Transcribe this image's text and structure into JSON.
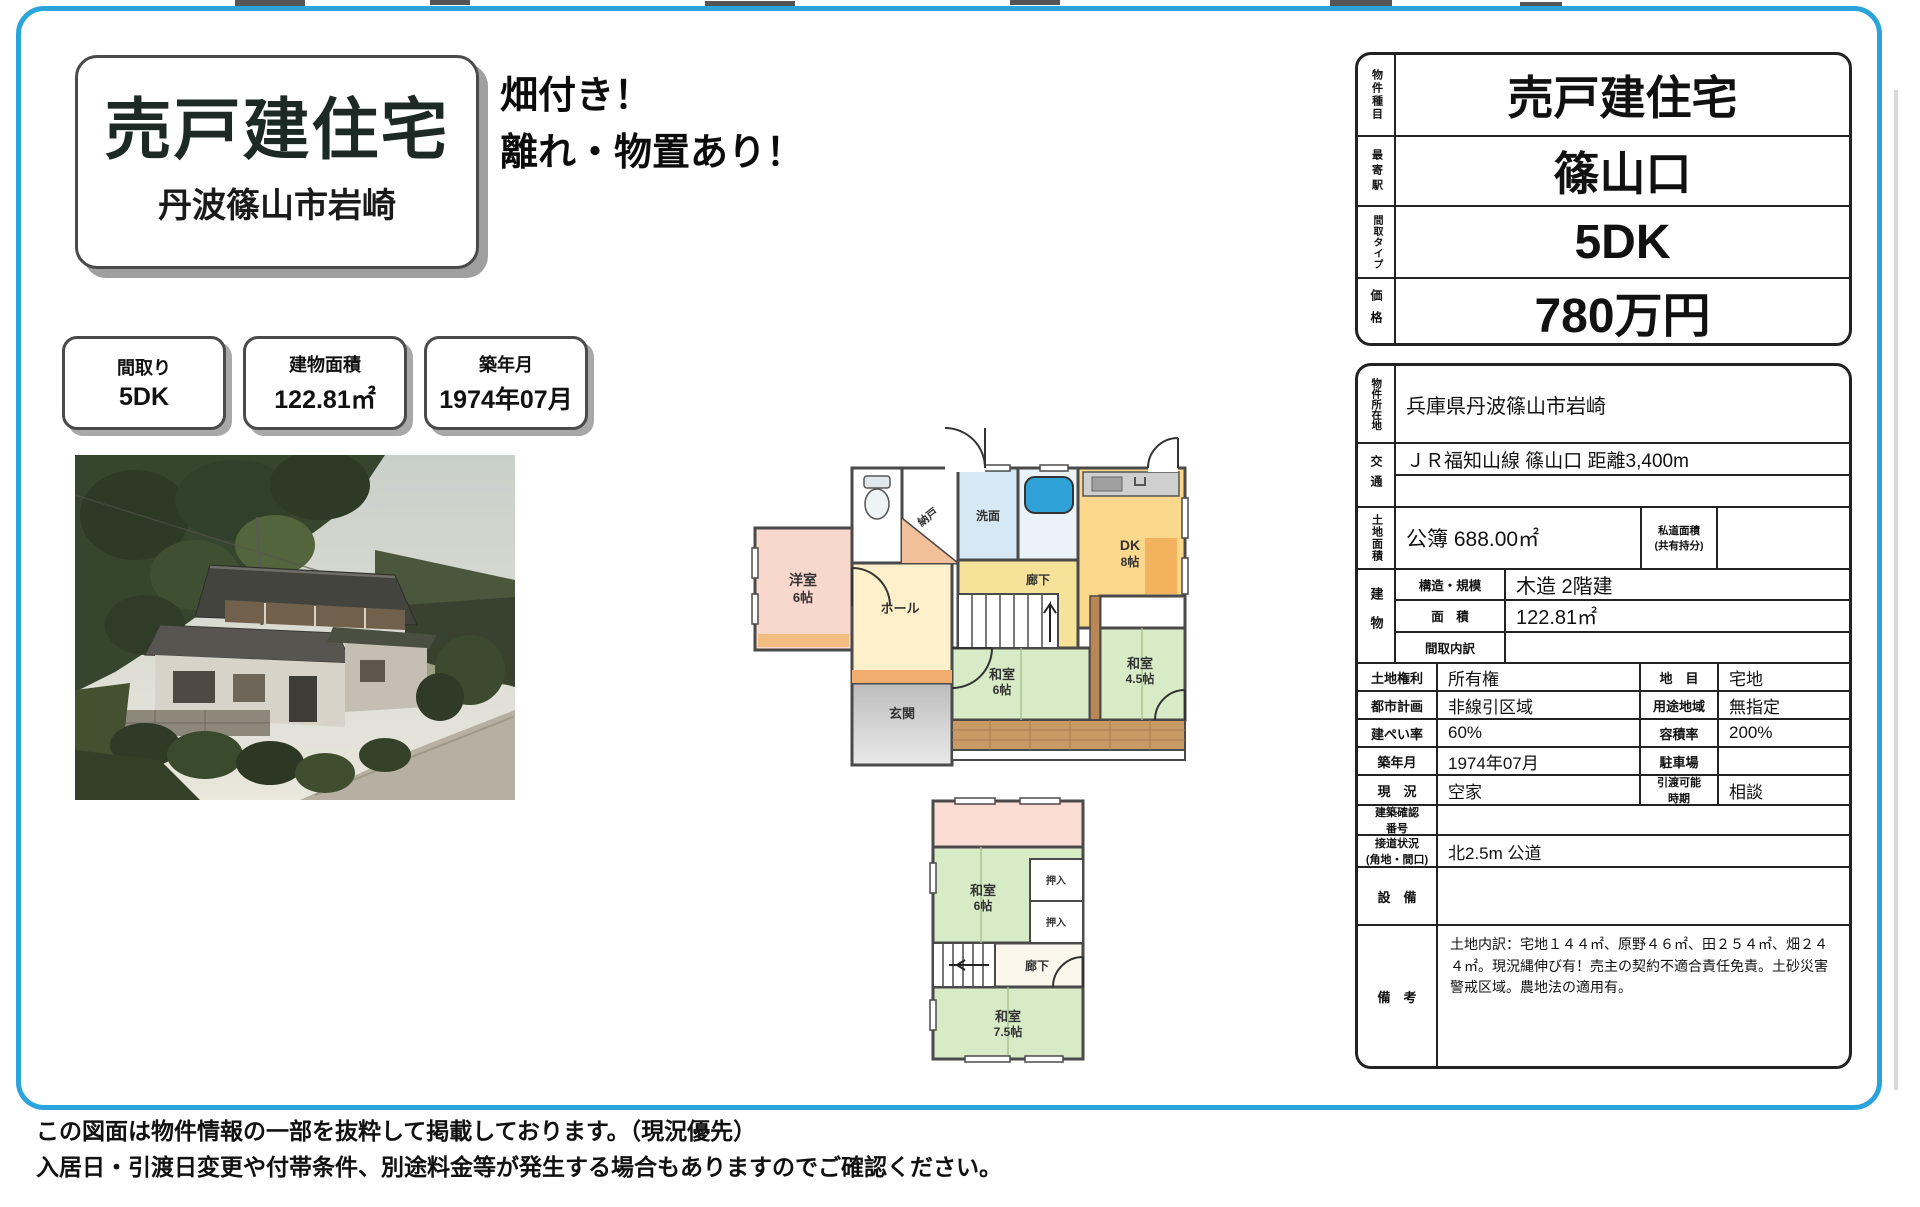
{
  "colors": {
    "frame_blue": "#2ba4dc",
    "room_pink": "#f8d7cc",
    "room_green": "#d8ebc7",
    "room_yellow_dk": "#fbd88c",
    "room_yellow_hall": "#fdf0ca",
    "room_yellow_corridor": "#f7e29a",
    "room_blue_senmen": "#d6e8f3",
    "bath_tub_blue": "#2fa3d8",
    "genkan_gray": "#c9c9c9",
    "engawa_wood": "#c89a66"
  },
  "header": {
    "title": "売戸建住宅",
    "subtitle": "丹波篠山市岩崎",
    "catch_line1": "畑付き！",
    "catch_line2": "離れ・物置あり！"
  },
  "info_boxes": [
    {
      "label": "間取り",
      "value": "5DK"
    },
    {
      "label": "建物面積",
      "value": "122.81㎡"
    },
    {
      "label": "築年月",
      "value": "1974年07月"
    }
  ],
  "summary_table": {
    "rows": [
      {
        "label": "物件種目",
        "value": "売戸建住宅"
      },
      {
        "label": "最寄駅",
        "value": "篠山口"
      },
      {
        "label": "間取タイプ",
        "value": "5DK"
      },
      {
        "label": "価格",
        "value": "780万円"
      }
    ]
  },
  "detail_table": {
    "location": {
      "label": "物件所在地",
      "value": "兵庫県丹波篠山市岩崎"
    },
    "transport": {
      "label": "交通",
      "value": "ＪＲ福知山線 篠山口 距離3,400m",
      "value2": ""
    },
    "land": {
      "label": "土地面積",
      "value": "公簿 688.00㎡",
      "sub_label": "私道面積\n(共有持分)",
      "sub_value": ""
    },
    "building": {
      "label": "建物",
      "rows": [
        {
          "label": "構造・規模",
          "value": "木造 2階建"
        },
        {
          "label": "面　積",
          "value": "122.81㎡"
        },
        {
          "label": "間取内訳",
          "value": ""
        }
      ]
    },
    "pairs": [
      {
        "label1": "土地権利",
        "value1": "所有権",
        "label2": "地　目",
        "value2": "宅地"
      },
      {
        "label1": "都市計画",
        "value1": "非線引区域",
        "label2": "用途地域",
        "value2": "無指定"
      },
      {
        "label1": "建ぺい率",
        "value1": "60%",
        "label2": "容積率",
        "value2": "200%"
      },
      {
        "label1": "築年月",
        "value1": "1974年07月",
        "label2": "駐車場",
        "value2": ""
      },
      {
        "label1": "現　況",
        "value1": "空家",
        "label2": "引渡可能\n時期",
        "value2": "相談"
      }
    ],
    "fulls": [
      {
        "label": "建築確認\n番号",
        "value": ""
      },
      {
        "label": "接道状況\n(角地・間口)",
        "value": "北2.5m 公道"
      },
      {
        "label": "設　備",
        "value": ""
      },
      {
        "label": "備　考",
        "value": "土地内訳：宅地１４４㎡、原野４６㎡、田２５４㎡、畑２４４㎡。現況縄伸び有！売主の契約不適合責任免責。土砂災害警戒区域。農地法の適用有。"
      }
    ]
  },
  "floorplan1": {
    "room_yoshitsu": "洋室",
    "size_yoshitsu": "6帖",
    "room_nando": "納戸",
    "room_senmen": "洗面",
    "room_dk": "DK",
    "size_dk": "8帖",
    "room_rouka": "廊下",
    "room_hall": "ホール",
    "room_genkan": "玄関",
    "room_washitsu6": "和室",
    "size_washitsu6": "6帖",
    "room_washitsu45": "和室",
    "size_washitsu45": "4.5帖"
  },
  "floorplan2": {
    "room_washitsu6": "和室",
    "size_washitsu6": "6帖",
    "oshiire": "押入",
    "room_rouka": "廊下",
    "room_washitsu75": "和室",
    "size_washitsu75": "7.5帖"
  },
  "footer": {
    "line1": "この図面は物件情報の一部を抜粋して掲載しております。（現況優先）",
    "line2": "入居日・引渡日変更や付帯条件、別途料金等が発生する場合もありますのでご確認ください。"
  }
}
